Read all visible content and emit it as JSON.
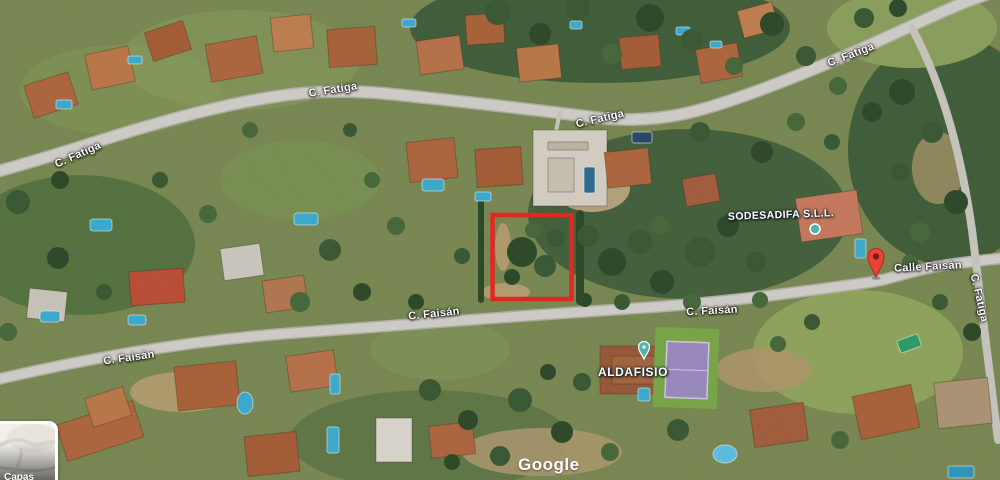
{
  "map": {
    "street_labels": [
      "C. Fatiga",
      "C. Fatiga",
      "C. Fatiga",
      "C. Fatiga",
      "C. Fatiga",
      "C. Faisán",
      "C. Faisán",
      "C. Faisán",
      "Calle Faisán"
    ],
    "pois": {
      "business_label": "SODESADIFA S.L.L.",
      "clinic_label": "ALDAFISIO"
    },
    "annotation": {
      "plot_outline_color": "#e02920"
    },
    "markers": {
      "pin_color": "#ea4335",
      "pin_hole_color": "#7a1d12",
      "poi_color": "#4db6ac"
    },
    "watermark": "Google",
    "layers_control": {
      "label": "Capas"
    }
  }
}
